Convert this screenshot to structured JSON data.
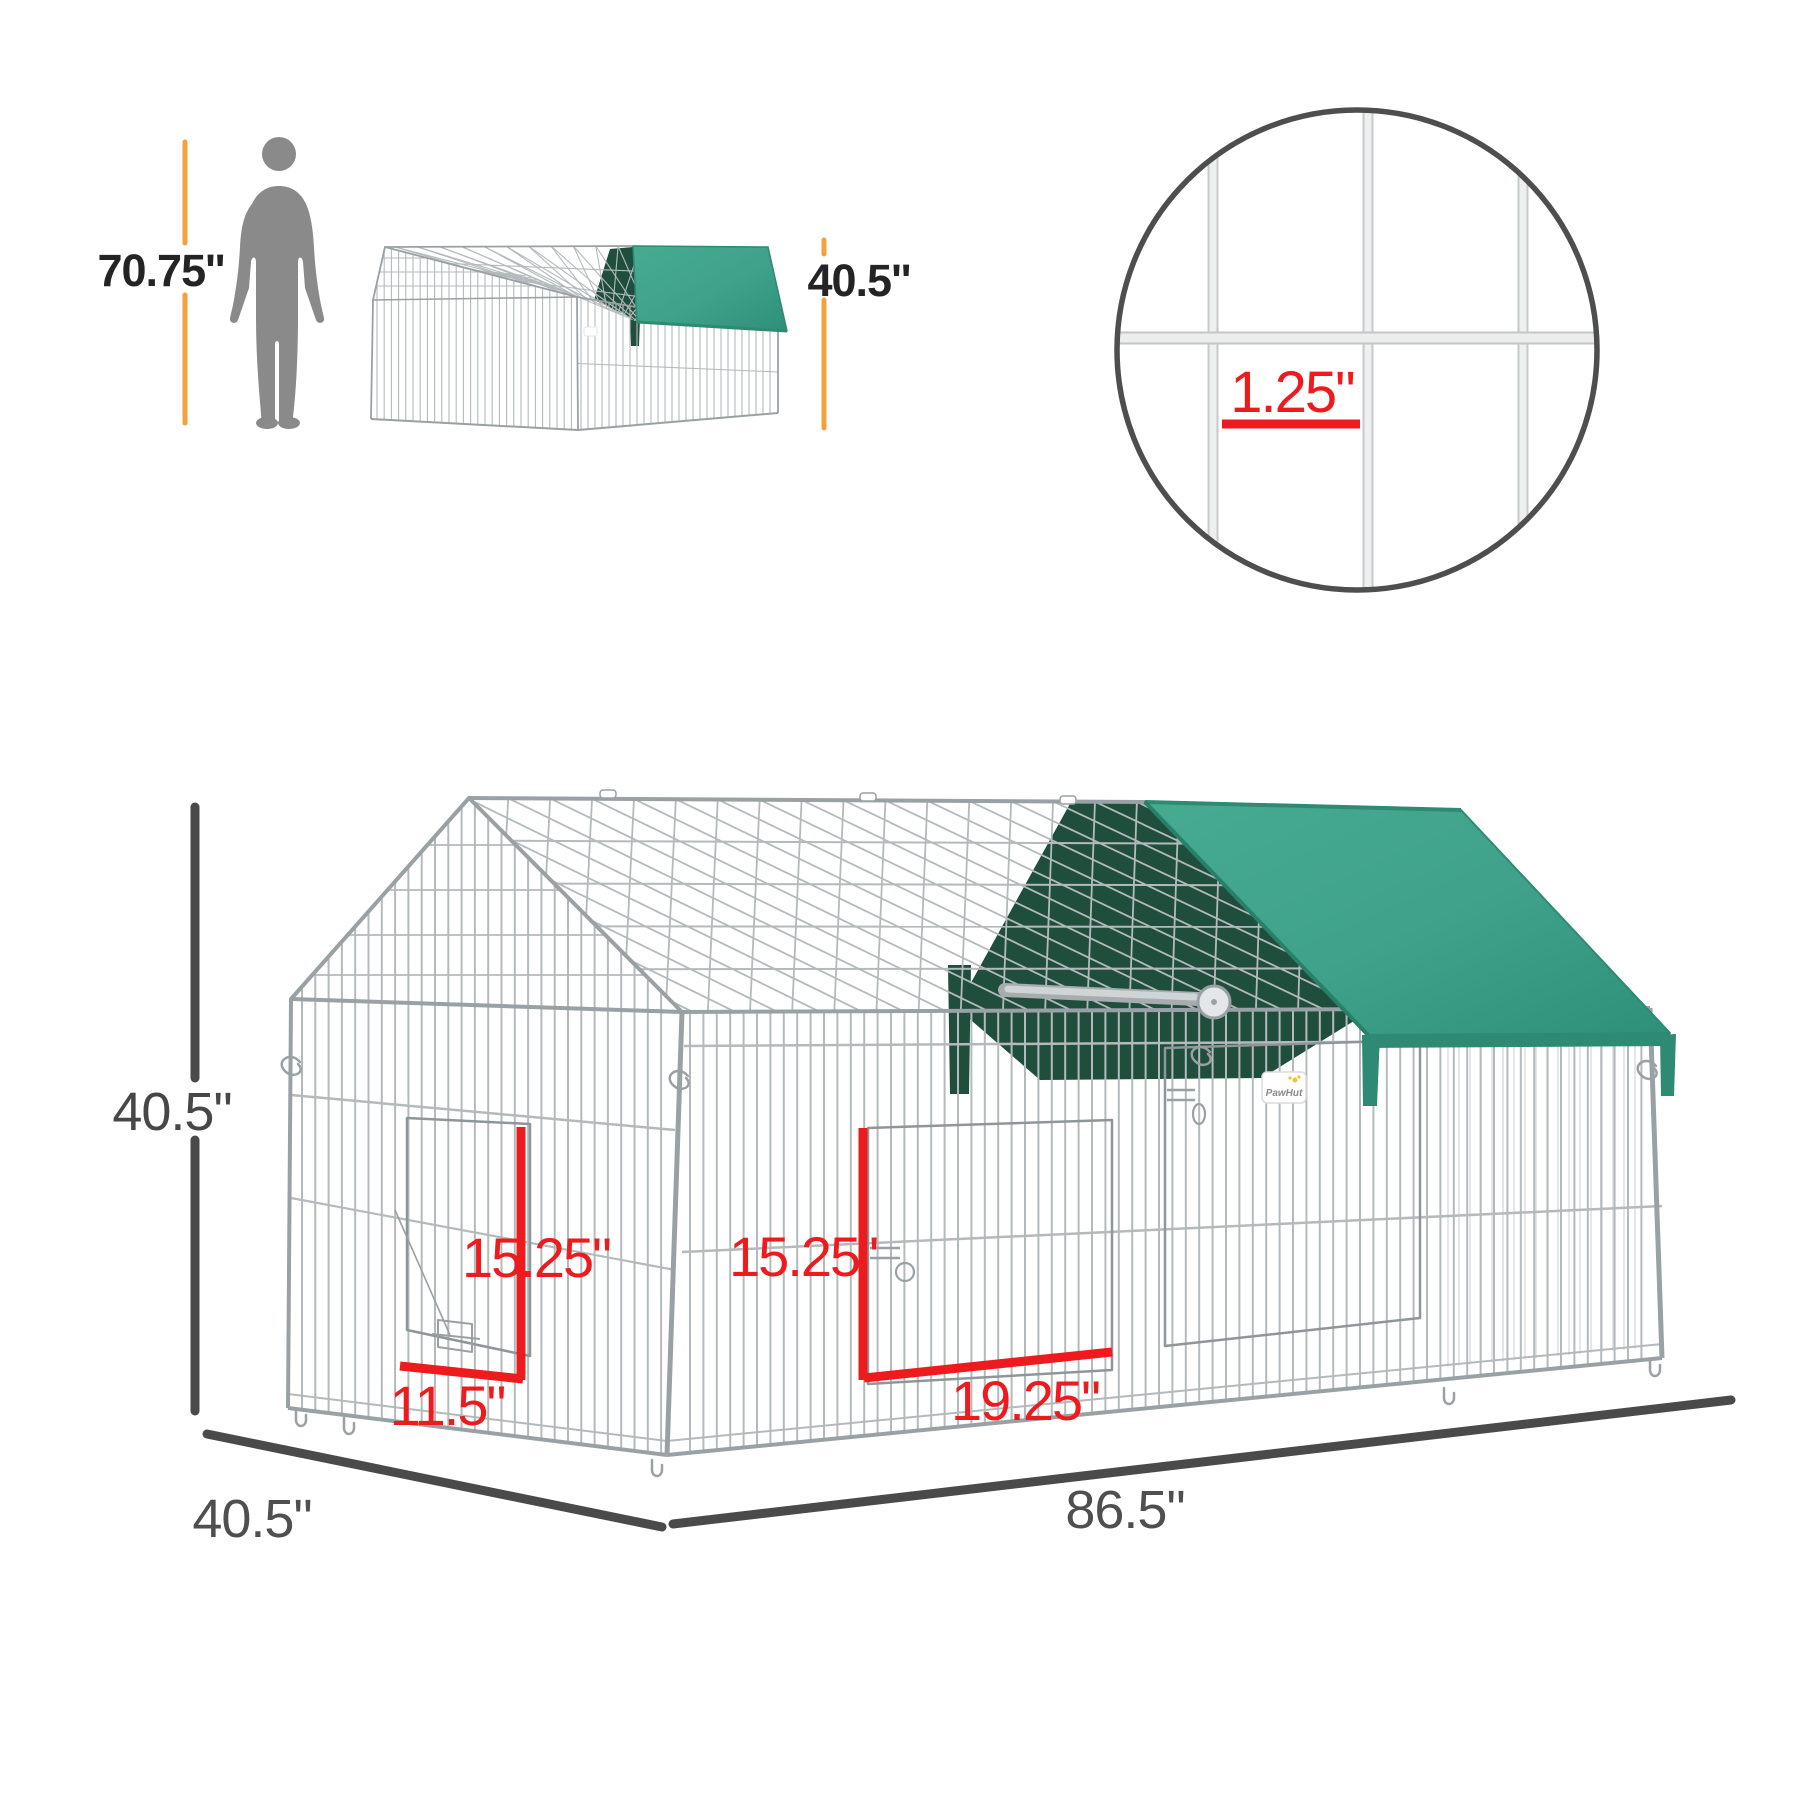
{
  "scale_reference": {
    "person_icon": "person-silhouette",
    "person_height_label": "70.75''",
    "small_cage_height_label": "40.5''"
  },
  "mesh_detail": {
    "wire_spacing_label": "1.25\""
  },
  "main_cage": {
    "brand_tag": "PawHut",
    "height_label": "40.5\"",
    "depth_label": "40.5\"",
    "length_label": "86.5\"",
    "left_door": {
      "height_label": "15.25\"",
      "width_label": "11.5\""
    },
    "front_door": {
      "height_label": "15.25\"",
      "width_label": "19.25\""
    }
  },
  "colors": {
    "tarp_green": "#3FA189",
    "tarp_green_edge": "#2E8A72",
    "tarp_dark_green": "#1F4E3D",
    "dimension_red": "#ED1B1E",
    "dimension_gray": "#4A4A4A",
    "reference_orange": "#F2A13B",
    "wire_gray": "#B4BABC",
    "wire_gray_dark": "#9AA1A4",
    "wire_gray_faint": "#D9DCDD",
    "silhouette_gray": "#8A8A8A",
    "text_dark": "#242424",
    "text_gray": "#4F4F4F"
  }
}
